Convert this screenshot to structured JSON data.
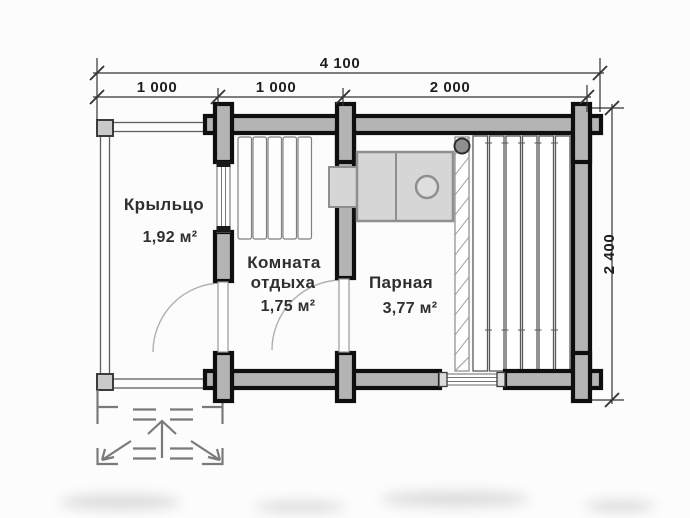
{
  "rooms": {
    "porch": {
      "name": "Крыльцо",
      "area": "1,92 м²"
    },
    "rest": {
      "name_line1": "Комната",
      "name_line2": "отдыха",
      "area": "1,75 м²"
    },
    "steam": {
      "name": "Парная",
      "area": "3,77 м²"
    }
  },
  "dimensions": {
    "total_width": "4 100",
    "seg1": "1 000",
    "seg2": "1 000",
    "seg3": "2 000",
    "height": "2 400"
  },
  "legend": {
    "wall_fill_color": "#b4b4b4",
    "wall_stroke_color": "#0f0f0f",
    "stove_fill_color": "#d6d6d6",
    "text_color": "#2f2f2f"
  }
}
